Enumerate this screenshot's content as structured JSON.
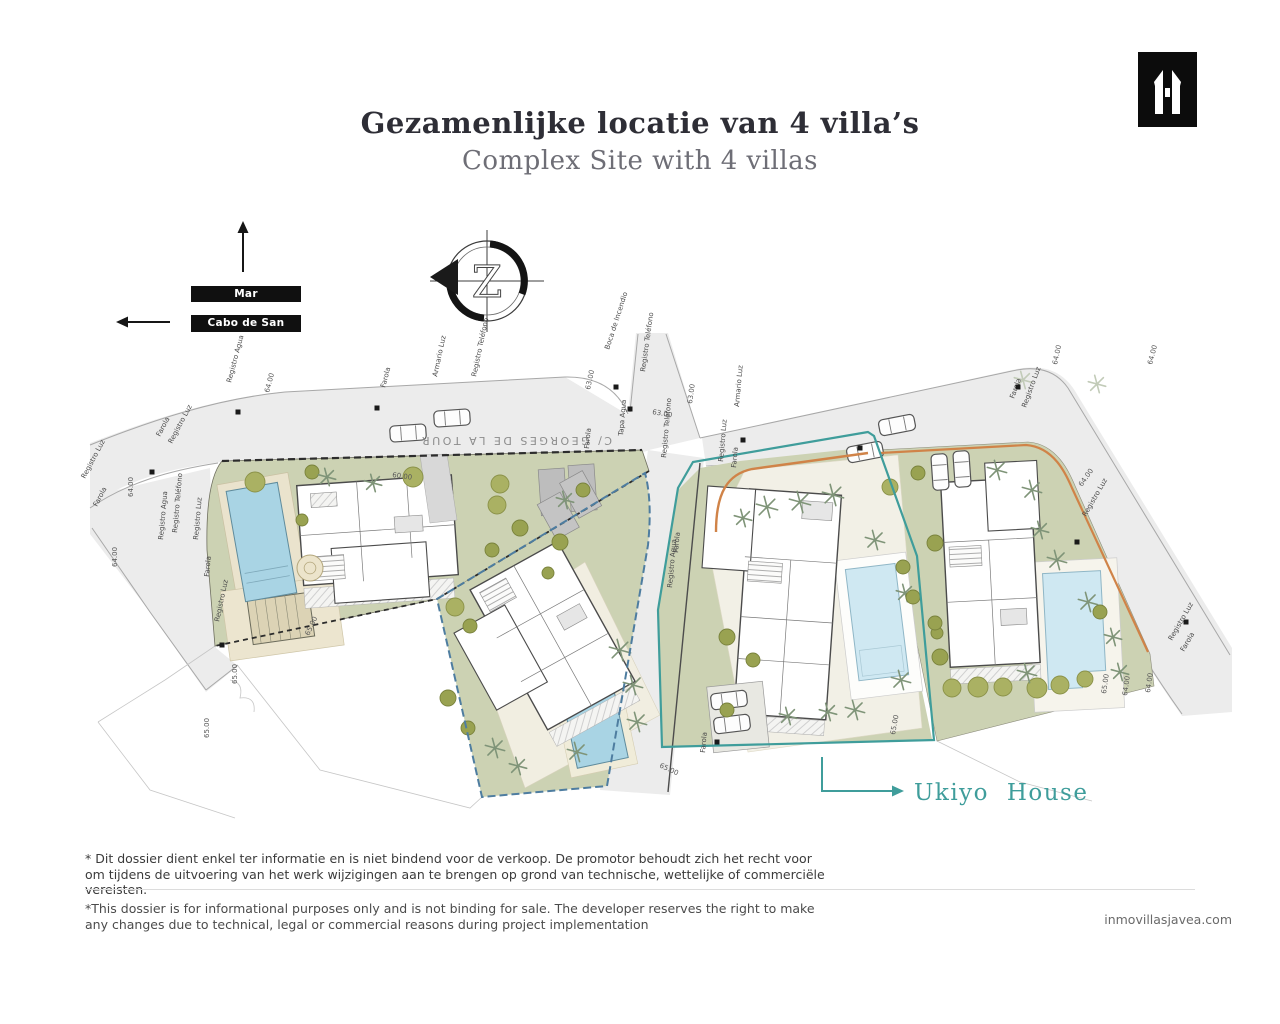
{
  "header": {
    "title_nl": "Gezamenlijke locatie van 4 villa’s",
    "title_en": "Complex Site with 4 villas"
  },
  "logo": {
    "name": "inmo-villas-monogram"
  },
  "directions": {
    "sea": "Mar Mediterráneo",
    "cape": "Cabo de San Antonio"
  },
  "compass": {
    "letter": "Z"
  },
  "plan": {
    "road_name": "C/ GEORGES DE LA TOUR",
    "ukiyo_label": "Ukiyo House",
    "labels": [
      {
        "t": "Registro Agua",
        "x": 231,
        "y": 383,
        "r": -75
      },
      {
        "t": "64.00",
        "x": 269,
        "y": 393,
        "r": -75
      },
      {
        "t": "Farola",
        "x": 385,
        "y": 388,
        "r": -75
      },
      {
        "t": "Armario Luz",
        "x": 437,
        "y": 377,
        "r": -78
      },
      {
        "t": "Registro Teléfono",
        "x": 476,
        "y": 377,
        "r": -78
      },
      {
        "t": "Boca de Incendio",
        "x": 609,
        "y": 350,
        "r": -72
      },
      {
        "t": "63.00",
        "x": 590,
        "y": 390,
        "r": -78
      },
      {
        "t": "Registro Teléfono",
        "x": 645,
        "y": 372,
        "r": -82
      },
      {
        "t": "63.00",
        "x": 652,
        "y": 414,
        "r": 10
      },
      {
        "t": "63.00",
        "x": 692,
        "y": 404,
        "r": -82
      },
      {
        "t": "Tapa Agua",
        "x": 623,
        "y": 436,
        "r": -85
      },
      {
        "t": "Farola",
        "x": 589,
        "y": 449,
        "r": -85
      },
      {
        "t": "Registro Teléfono",
        "x": 666,
        "y": 458,
        "r": -85
      },
      {
        "t": "Armario Luz",
        "x": 739,
        "y": 407,
        "r": -85
      },
      {
        "t": "Registro Luz",
        "x": 723,
        "y": 462,
        "r": -85
      },
      {
        "t": "Farola",
        "x": 736,
        "y": 468,
        "r": -85
      },
      {
        "t": "Registro Agua",
        "x": 672,
        "y": 588,
        "r": -85
      },
      {
        "t": "Farola",
        "x": 678,
        "y": 553,
        "r": -85
      },
      {
        "t": "Farola",
        "x": 1014,
        "y": 399,
        "r": -70
      },
      {
        "t": "Registro Luz",
        "x": 1026,
        "y": 408,
        "r": -70
      },
      {
        "t": "64.00",
        "x": 1057,
        "y": 365,
        "r": -78
      },
      {
        "t": "64.00",
        "x": 1152,
        "y": 365,
        "r": -75
      },
      {
        "t": "64.00",
        "x": 1082,
        "y": 487,
        "r": -55
      },
      {
        "t": "Registro Luz",
        "x": 1086,
        "y": 517,
        "r": -60
      },
      {
        "t": "Registro Luz",
        "x": 1172,
        "y": 641,
        "r": -60
      },
      {
        "t": "Farola",
        "x": 1184,
        "y": 652,
        "r": -60
      },
      {
        "t": "65.00",
        "x": 1106,
        "y": 694,
        "r": -82
      },
      {
        "t": "64.00",
        "x": 1127,
        "y": 696,
        "r": -82
      },
      {
        "t": "64.00",
        "x": 1150,
        "y": 693,
        "r": -82
      },
      {
        "t": "Farola",
        "x": 160,
        "y": 437,
        "r": -62
      },
      {
        "t": "Registro Luz",
        "x": 172,
        "y": 444,
        "r": -62
      },
      {
        "t": "Registro Luz",
        "x": 85,
        "y": 479,
        "r": -62
      },
      {
        "t": "Farola",
        "x": 97,
        "y": 507,
        "r": -62
      },
      {
        "t": "64.00",
        "x": 133,
        "y": 497,
        "r": -90
      },
      {
        "t": "64.00",
        "x": 117,
        "y": 567,
        "r": -90
      },
      {
        "t": "Registro Agua",
        "x": 163,
        "y": 540,
        "r": -85
      },
      {
        "t": "Registro Teléfono",
        "x": 177,
        "y": 533,
        "r": -85
      },
      {
        "t": "Registro Luz",
        "x": 198,
        "y": 540,
        "r": -85
      },
      {
        "t": "Farola",
        "x": 209,
        "y": 577,
        "r": -85
      },
      {
        "t": "Registro Luz",
        "x": 219,
        "y": 622,
        "r": -78
      },
      {
        "t": "65.00",
        "x": 237,
        "y": 684,
        "r": -90
      },
      {
        "t": "65.00",
        "x": 209,
        "y": 738,
        "r": -90
      },
      {
        "t": "65.00",
        "x": 309,
        "y": 636,
        "r": -65
      },
      {
        "t": "60.00",
        "x": 392,
        "y": 477,
        "r": 8
      },
      {
        "t": "65.00",
        "x": 659,
        "y": 767,
        "r": 25
      },
      {
        "t": "Farola",
        "x": 705,
        "y": 753,
        "r": -85
      },
      {
        "t": "65.00",
        "x": 895,
        "y": 735,
        "r": -80
      }
    ],
    "trees": [
      [
        255,
        482,
        10,
        "o"
      ],
      [
        312,
        472,
        7,
        "od"
      ],
      [
        413,
        477,
        10,
        "o"
      ],
      [
        500,
        484,
        9,
        "o"
      ],
      [
        560,
        542,
        8,
        "od"
      ],
      [
        583,
        490,
        7,
        "od"
      ],
      [
        302,
        520,
        6,
        "od"
      ],
      [
        310,
        568,
        13,
        "f"
      ],
      [
        327,
        477,
        9,
        "p"
      ],
      [
        373,
        483,
        9,
        "p"
      ],
      [
        497,
        505,
        9,
        "o"
      ],
      [
        520,
        528,
        8,
        "od"
      ],
      [
        492,
        550,
        7,
        "od"
      ],
      [
        455,
        607,
        9,
        "o"
      ],
      [
        470,
        626,
        7,
        "od"
      ],
      [
        448,
        698,
        8,
        "od"
      ],
      [
        468,
        728,
        7,
        "od"
      ],
      [
        548,
        573,
        6,
        "od"
      ],
      [
        620,
        650,
        11,
        "p"
      ],
      [
        633,
        685,
        10,
        "p"
      ],
      [
        637,
        722,
        10,
        "p"
      ],
      [
        577,
        752,
        10,
        "p"
      ],
      [
        495,
        748,
        10,
        "p"
      ],
      [
        518,
        766,
        9,
        "p"
      ],
      [
        565,
        500,
        9,
        "p"
      ],
      [
        890,
        487,
        8,
        "o"
      ],
      [
        903,
        567,
        7,
        "od"
      ],
      [
        727,
        637,
        8,
        "od"
      ],
      [
        753,
        660,
        7,
        "od"
      ],
      [
        727,
        710,
        7,
        "od"
      ],
      [
        937,
        633,
        6,
        "od"
      ],
      [
        767,
        507,
        11,
        "p"
      ],
      [
        800,
        502,
        11,
        "p"
      ],
      [
        833,
        495,
        11,
        "p"
      ],
      [
        743,
        518,
        9,
        "p"
      ],
      [
        875,
        540,
        10,
        "p"
      ],
      [
        905,
        593,
        9,
        "p"
      ],
      [
        901,
        680,
        10,
        "p"
      ],
      [
        855,
        710,
        10,
        "p"
      ],
      [
        828,
        712,
        9,
        "p"
      ],
      [
        788,
        716,
        9,
        "p"
      ],
      [
        918,
        473,
        7,
        "od"
      ],
      [
        935,
        543,
        8,
        "od"
      ],
      [
        913,
        597,
        7,
        "od"
      ],
      [
        935,
        623,
        7,
        "od"
      ],
      [
        940,
        657,
        8,
        "od"
      ],
      [
        952,
        688,
        9,
        "o"
      ],
      [
        978,
        687,
        10,
        "o"
      ],
      [
        1003,
        687,
        9,
        "o"
      ],
      [
        1037,
        688,
        10,
        "o"
      ],
      [
        1060,
        685,
        9,
        "o"
      ],
      [
        1085,
        679,
        8,
        "o"
      ],
      [
        1100,
        612,
        7,
        "od"
      ],
      [
        997,
        470,
        10,
        "p"
      ],
      [
        1032,
        490,
        10,
        "p"
      ],
      [
        1040,
        530,
        9,
        "p"
      ],
      [
        1057,
        560,
        10,
        "p"
      ],
      [
        1088,
        602,
        10,
        "p"
      ],
      [
        1113,
        637,
        9,
        "p"
      ],
      [
        1120,
        672,
        9,
        "p"
      ],
      [
        1027,
        673,
        10,
        "p"
      ],
      [
        1023,
        380,
        9,
        "p2"
      ],
      [
        1097,
        384,
        9,
        "p2"
      ]
    ],
    "dots": [
      [
        238,
        412
      ],
      [
        377,
        408
      ],
      [
        616,
        387
      ],
      [
        630,
        409
      ],
      [
        743,
        440
      ],
      [
        1018,
        387
      ],
      [
        1186,
        622
      ],
      [
        152,
        472
      ],
      [
        222,
        645
      ],
      [
        717,
        742
      ],
      [
        1077,
        542
      ],
      [
        860,
        448
      ]
    ]
  },
  "footer": {
    "note_nl": "* Dit dossier dient enkel ter informatie en is niet bindend voor de verkoop. De promotor behoudt zich het recht voor om tijdens de uitvoering van het werk wijzigingen aan te brengen op grond van technische, wettelijke of commerciële vereisten.",
    "note_en": "*This dossier is for informational purposes only and is not binding for sale. The developer reserves the right to make any changes due to technical, legal or commercial reasons during project implementation",
    "website": "inmovillasjavea.com"
  },
  "colors": {
    "teal": "#3f9d9b",
    "plot_green": "#ccd2b3",
    "pool_blue": "#a9d4e4",
    "pool_light": "#cfe8f2",
    "road_gray": "#ececec",
    "orange": "#d08348",
    "ink": "#2e2e36",
    "muted": "#6e6e76"
  }
}
